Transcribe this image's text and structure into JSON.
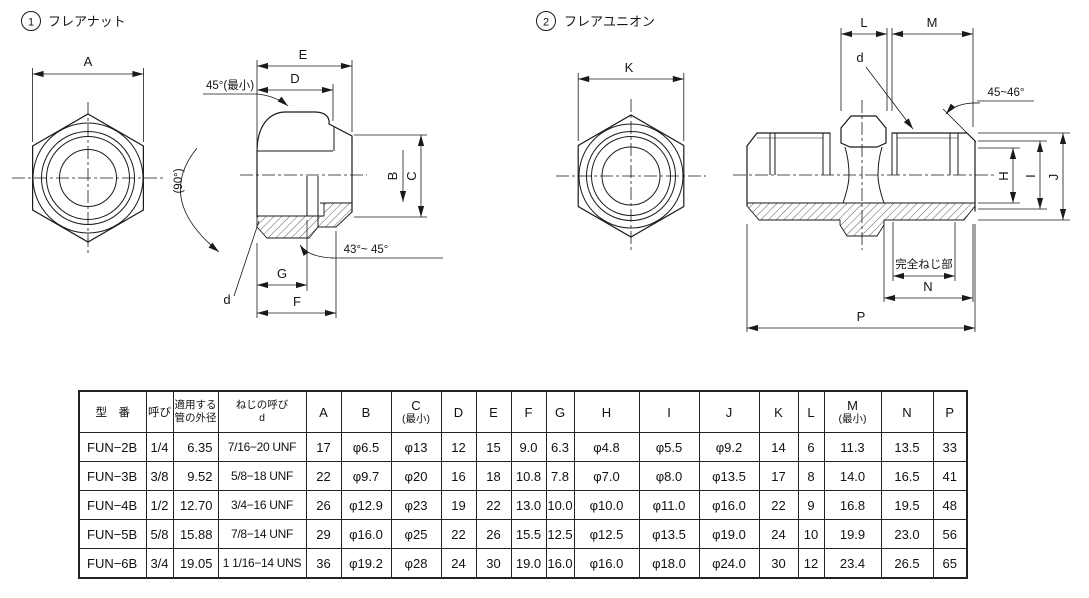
{
  "sheet": {
    "background": "#ffffff",
    "ink": "#1a1a1a"
  },
  "figure1": {
    "number": "1",
    "title": "フレアナット",
    "labels": {
      "A": "A",
      "E": "E",
      "D": "D",
      "B": "B",
      "C": "C",
      "G": "G",
      "F": "F",
      "d": "d",
      "angle_top": "45°(最小)",
      "angle_90": "(90°)",
      "angle_bottom": "43°~ 45°"
    }
  },
  "figure2": {
    "number": "2",
    "title": "フレアユニオン",
    "labels": {
      "K": "K",
      "L": "L",
      "M": "M",
      "d": "d",
      "angle_chamfer": "45~46°",
      "H": "H",
      "I": "I",
      "J": "J",
      "thread_note": "完全ねじ部",
      "N": "N",
      "P": "P"
    }
  },
  "table": {
    "headers": [
      {
        "line1": "型　番"
      },
      {
        "line1": "呼び"
      },
      {
        "line1": "適用する",
        "line2": "管の外径"
      },
      {
        "line1": "ねじの呼び",
        "line2": "d"
      },
      {
        "line1": "A"
      },
      {
        "line1": "B"
      },
      {
        "line1": "C",
        "line2": "(最小)"
      },
      {
        "line1": "D"
      },
      {
        "line1": "E"
      },
      {
        "line1": "F"
      },
      {
        "line1": "G"
      },
      {
        "line1": "H"
      },
      {
        "line1": "I"
      },
      {
        "line1": "J"
      },
      {
        "line1": "K"
      },
      {
        "line1": "L"
      },
      {
        "line1": "M",
        "line2": "(最小)"
      },
      {
        "line1": "N"
      },
      {
        "line1": "P"
      }
    ],
    "rows": [
      [
        "FUN−2B",
        "1/4",
        "6.35",
        "7/16−20 UNF",
        "17",
        "φ6.5",
        "φ13",
        "12",
        "15",
        "9.0",
        "6.3",
        "φ4.8",
        "φ5.5",
        "φ9.2",
        "14",
        "6",
        "11.3",
        "13.5",
        "33"
      ],
      [
        "FUN−3B",
        "3/8",
        "9.52",
        "5/8−18 UNF",
        "22",
        "φ9.7",
        "φ20",
        "16",
        "18",
        "10.8",
        "7.8",
        "φ7.0",
        "φ8.0",
        "φ13.5",
        "17",
        "8",
        "14.0",
        "16.5",
        "41"
      ],
      [
        "FUN−4B",
        "1/2",
        "12.70",
        "3/4−16 UNF",
        "26",
        "φ12.9",
        "φ23",
        "19",
        "22",
        "13.0",
        "10.0",
        "φ10.0",
        "φ11.0",
        "φ16.0",
        "22",
        "9",
        "16.8",
        "19.5",
        "48"
      ],
      [
        "FUN−5B",
        "5/8",
        "15.88",
        "7/8−14 UNF",
        "29",
        "φ16.0",
        "φ25",
        "22",
        "26",
        "15.5",
        "12.5",
        "φ12.5",
        "φ13.5",
        "φ19.0",
        "24",
        "10",
        "19.9",
        "23.0",
        "56"
      ],
      [
        "FUN−6B",
        "3/4",
        "19.05",
        "1 1/16−14 UNS",
        "36",
        "φ19.2",
        "φ28",
        "24",
        "30",
        "19.0",
        "16.0",
        "φ16.0",
        "φ18.0",
        "φ24.0",
        "30",
        "12",
        "23.4",
        "26.5",
        "65"
      ]
    ]
  }
}
